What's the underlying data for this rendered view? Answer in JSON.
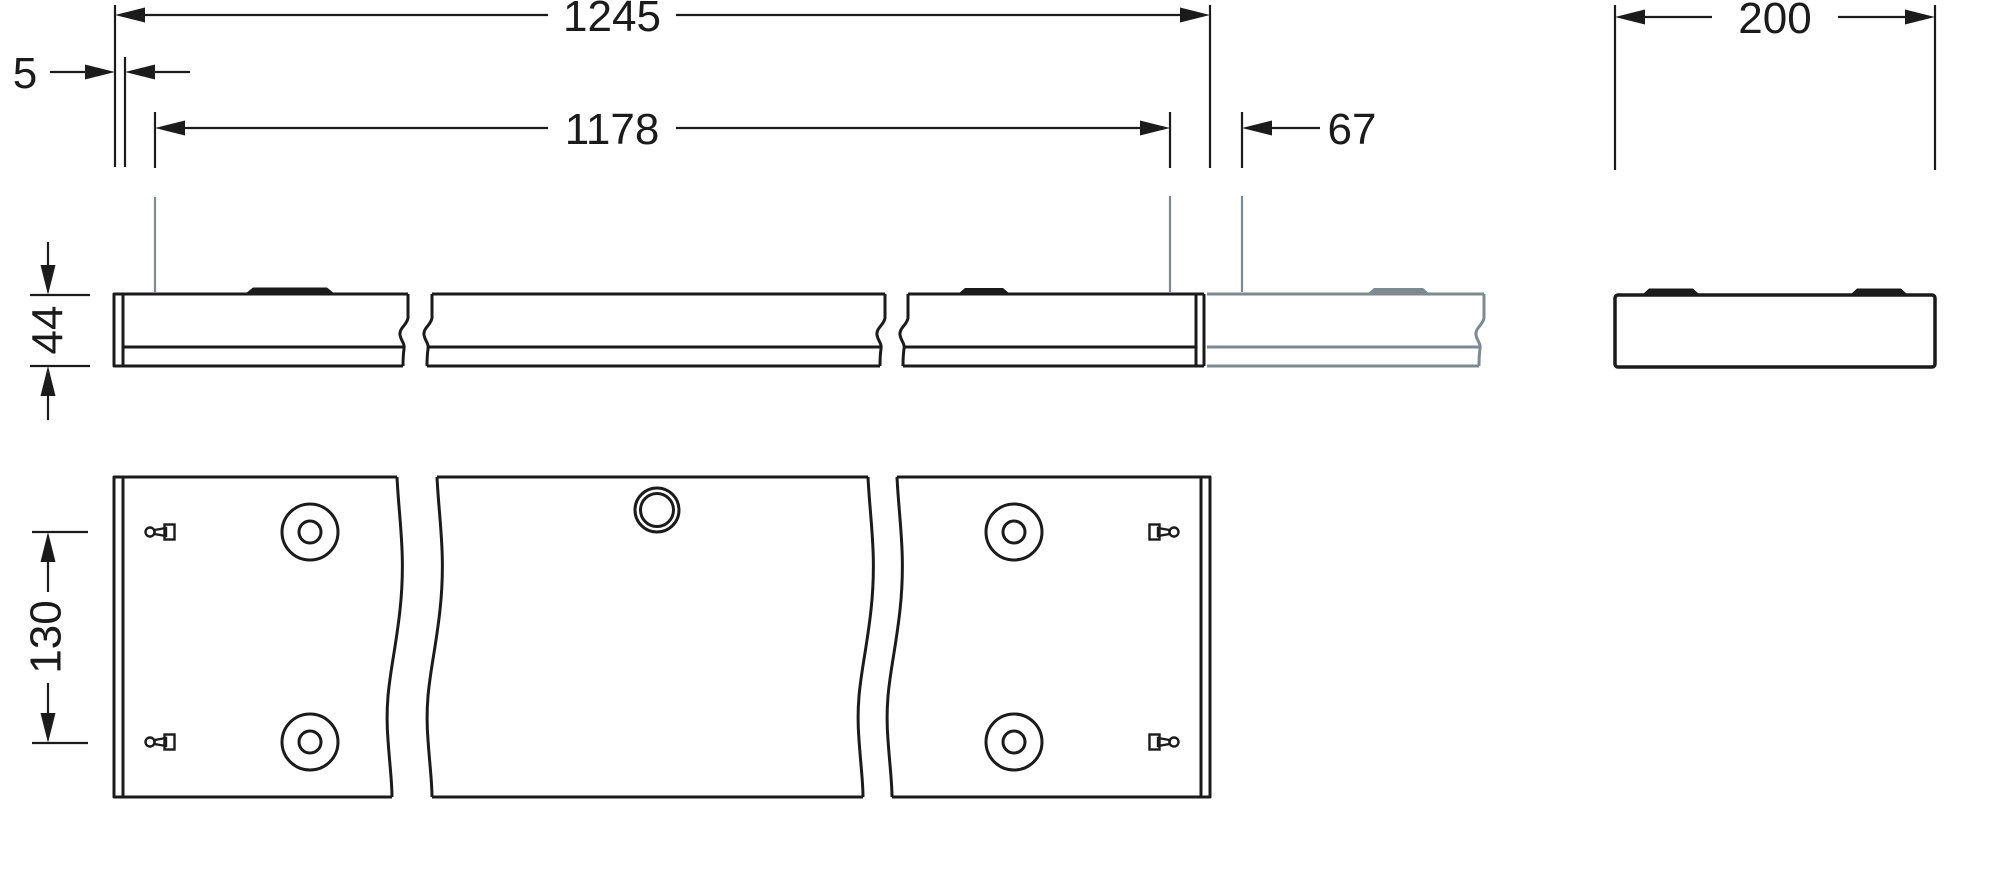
{
  "drawing": {
    "title": "linear-luminaire-dimension-drawing",
    "dimensions": {
      "overall_length": "1245",
      "end_gap": "5",
      "suspension_spacing": "1178",
      "joint_offset": "67",
      "profile_width": "200",
      "profile_height": "44",
      "mount_row_spacing": "130"
    },
    "colors": {
      "line": "#1b1b1b",
      "continuation_gray": "#7d8a8f",
      "background": "#ffffff"
    }
  }
}
